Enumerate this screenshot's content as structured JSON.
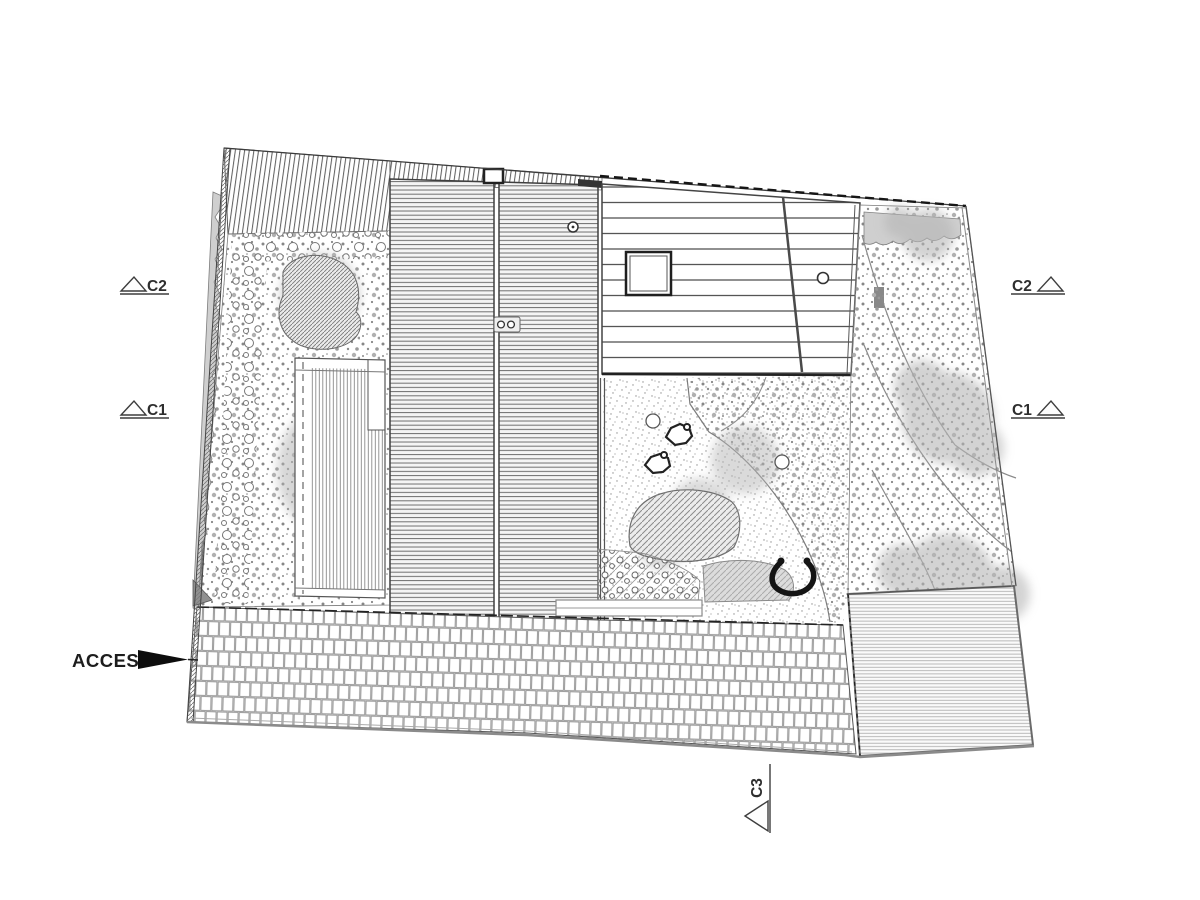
{
  "plan": {
    "access_label": "ACCES",
    "sections": {
      "left_c2": "C2",
      "left_c1": "C1",
      "right_c2": "C2",
      "right_c1": "C1",
      "bottom_c3": "C3"
    },
    "colors": {
      "ink": "#3a3a3a",
      "boundary_dash": "#161616",
      "hedge_gray": "#cfcfcf",
      "canopy_gray": "#b6b6b6",
      "paper": "#ffffff"
    }
  }
}
